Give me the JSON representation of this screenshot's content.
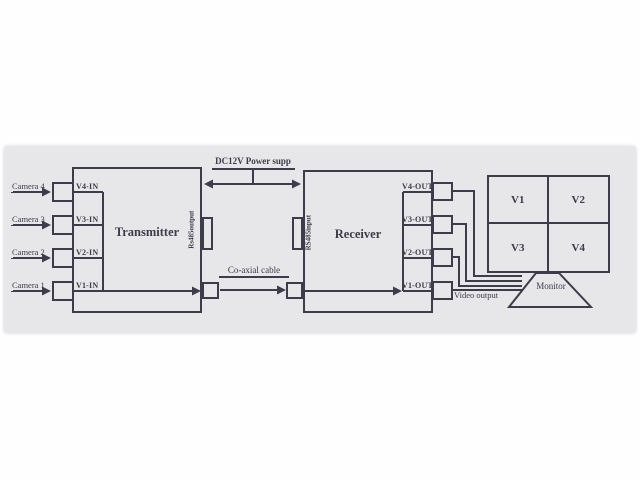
{
  "colors": {
    "ink": "#3c3c4b",
    "band": "#e7e6e8",
    "page": "#fefefe"
  },
  "cameras": {
    "items": [
      "Camera 4",
      "Camera 3",
      "Camera 2",
      "Camera 1"
    ]
  },
  "transmitter": {
    "title": "Transmitter",
    "serial_label": "Rs485output",
    "ports": [
      "V4-IN",
      "V3-IN",
      "V2-IN",
      "V1-IN"
    ]
  },
  "receiver": {
    "title": "Receiver",
    "serial_label": "RS485input",
    "ports": [
      "V4-OUT",
      "V3-OUT",
      "V2-OUT",
      "V1-OUT"
    ]
  },
  "links": {
    "power": "DC12V Power supp",
    "coax": "Co-axial cable",
    "video_out": "Video output"
  },
  "monitor": {
    "title": "Monitor",
    "quadrants": [
      "V1",
      "V2",
      "V3",
      "V4"
    ]
  }
}
